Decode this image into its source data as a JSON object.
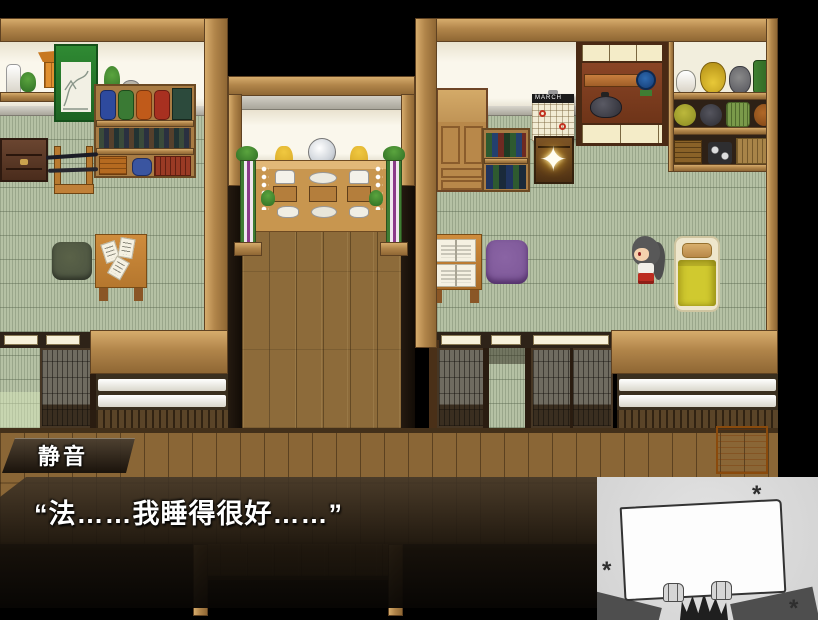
{
  "dialogue": {
    "speaker_name": "静音",
    "text": "“法……我睡得很好……”"
  },
  "map": {
    "calendar_month": "MARCH",
    "sparkle_icon": "✦"
  },
  "overlay_card": {
    "asterisks": [
      "*",
      "*",
      "*"
    ]
  },
  "colors": {
    "wood_frame": "#b9915a",
    "wood_floor": "#8d6b3a",
    "tatami_green": "#b5c1a4",
    "wall_cream": "#f6f1e2",
    "shoji_gray": "#6f6b60",
    "accent_orange": "#e8891e",
    "blanket_yellow": "#d0c92f",
    "cushion_purple": "#7b5596",
    "cushion_green": "#4a5240",
    "message_box_dark": "#221a12",
    "overlay_gray": "#d2d2d2",
    "sparkle_gold": "#ffd040"
  }
}
